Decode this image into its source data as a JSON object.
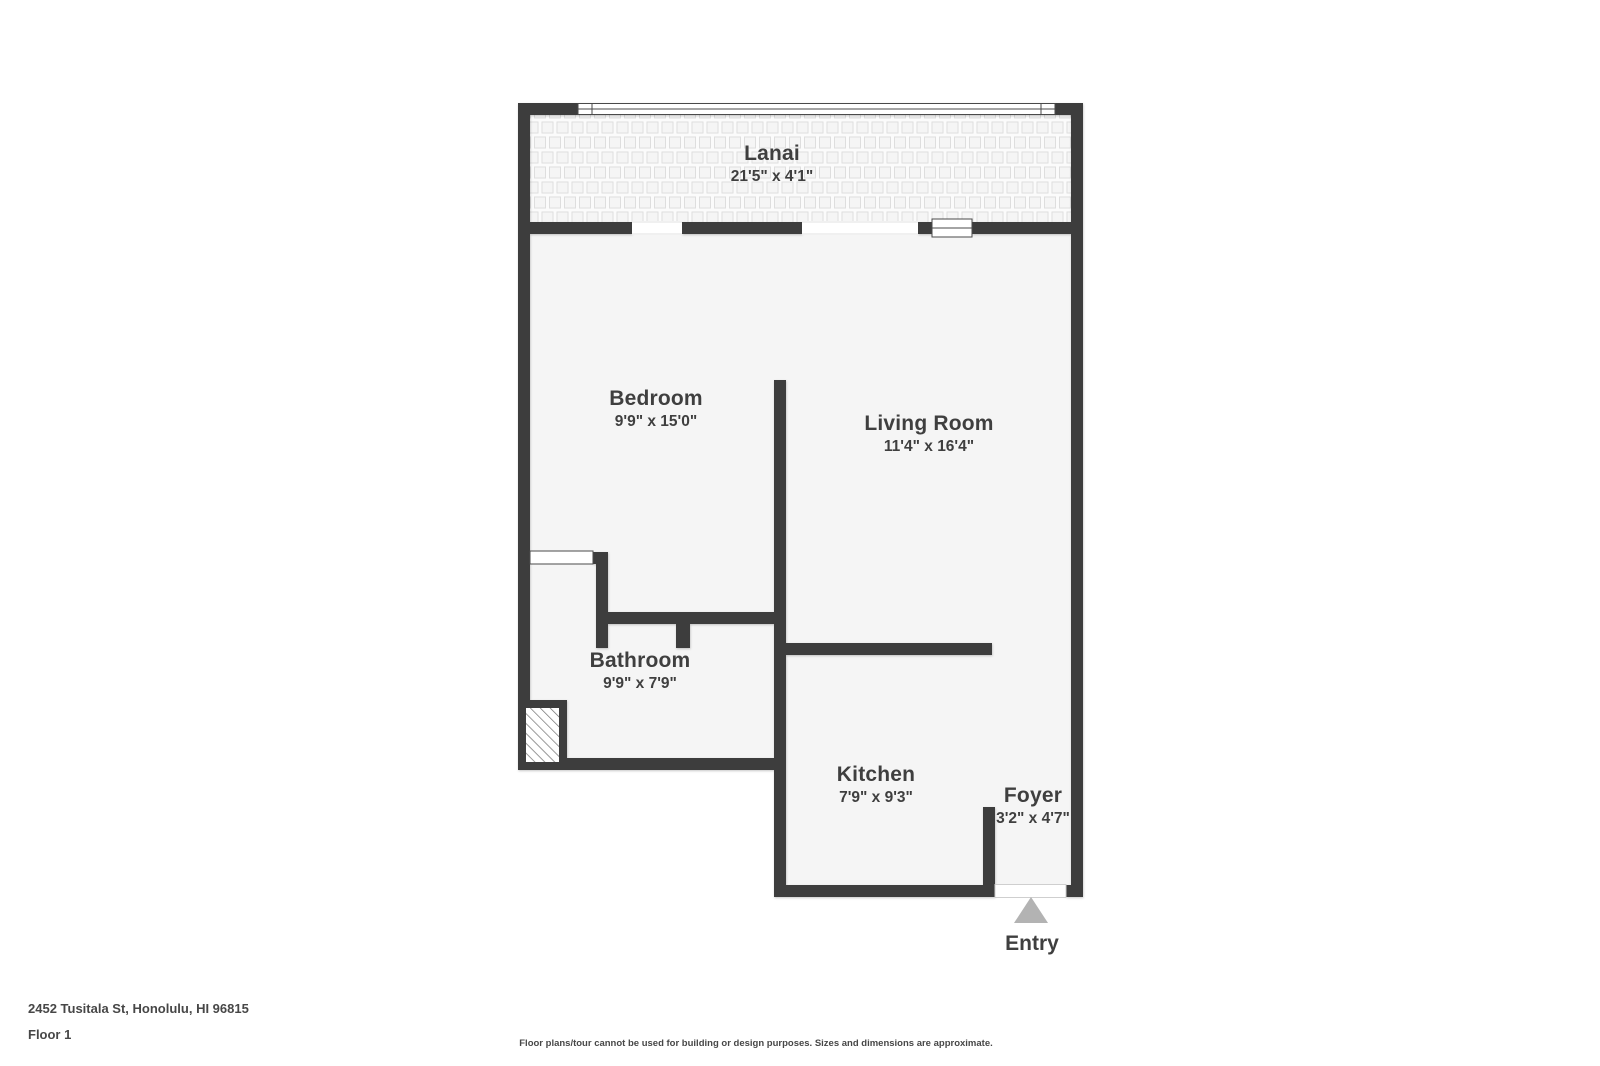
{
  "colors": {
    "wall": "#3C3C3C",
    "floor": "#F5F5F5",
    "text": "#3F3F3F",
    "entry_arrow": "#B3B3B3",
    "footer_text": "#474747"
  },
  "floor_plan": {
    "rooms": [
      {
        "id": "lanai",
        "name": "Lanai",
        "dims": "21'5\" x 4'1\""
      },
      {
        "id": "bedroom",
        "name": "Bedroom",
        "dims": "9'9\" x 15'0\""
      },
      {
        "id": "living-room",
        "name": "Living Room",
        "dims": "11'4\" x 16'4\""
      },
      {
        "id": "bathroom",
        "name": "Bathroom",
        "dims": "9'9\" x 7'9\""
      },
      {
        "id": "kitchen",
        "name": "Kitchen",
        "dims": "7'9\" x 9'3\""
      },
      {
        "id": "foyer",
        "name": "Foyer",
        "dims": "3'2\" x 4'7\""
      }
    ],
    "entry_label": "Entry"
  },
  "footer": {
    "address": "2452 Tusitala St, Honolulu, HI 96815",
    "floor": "Floor 1",
    "disclaimer": "Floor plans/tour cannot be used for building or design purposes. Sizes and dimensions are approximate."
  }
}
